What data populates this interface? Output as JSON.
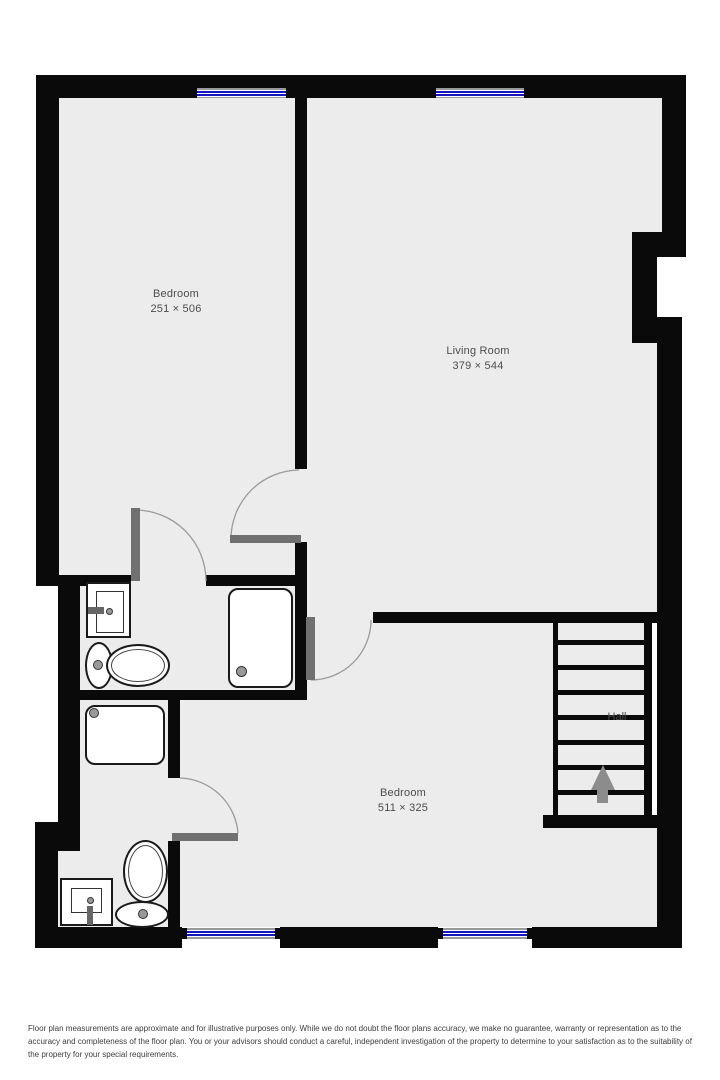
{
  "plan": {
    "type": "floor-plan",
    "rooms": [
      {
        "name": "Bedroom",
        "dims": "251 × 506"
      },
      {
        "name": "Living Room",
        "dims": "379 × 544"
      },
      {
        "name": "Bedroom",
        "dims": "511 × 325"
      },
      {
        "name": "Hall",
        "dims": ""
      }
    ],
    "stairs": {
      "steps": 8,
      "arrow_direction": "up"
    },
    "windows": {
      "top": 2,
      "bottom": 2
    },
    "fixtures": [
      "sink",
      "toilet",
      "shower-tray",
      "sink",
      "toilet",
      "shower-tray"
    ],
    "doors": 4
  },
  "colors": {
    "wall": "#0a0a0a",
    "floor": "#ececec",
    "window_blue": "#1616c0",
    "door_gray": "#707070",
    "arc_gray": "#9a9a9a",
    "fixture_line": "#1a1a1a",
    "arrow_gray": "#8c8c8c",
    "label_text": "#4d4d4d",
    "disclaimer_text": "#3d3d3d",
    "sill_gray": "#999999"
  },
  "footer": {
    "disclaimer": "Floor plan measurements are approximate and for illustrative purposes only. While we do not doubt the floor plans accuracy, we make no guarantee, warranty or representation as to the accuracy and completeness of the floor plan. You or your advisors should conduct a careful, independent investigation of the property to determine to your satisfaction as to the suitability of the property for your special requirements."
  }
}
